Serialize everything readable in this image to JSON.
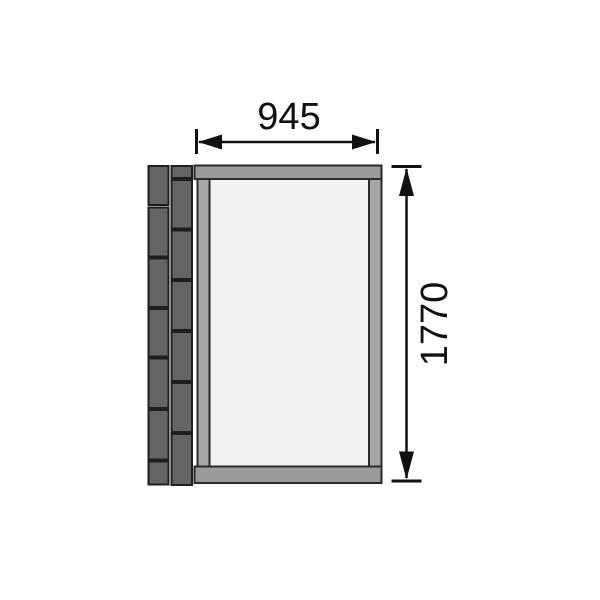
{
  "diagram": {
    "type": "technical-drawing",
    "width_dimension": {
      "label": "945"
    },
    "height_dimension": {
      "label": "1770"
    }
  },
  "colors": {
    "background": "#ffffff",
    "block_fill": "#646464",
    "block_border": "#1e1e1e",
    "rail_fill": "#9b9b9b",
    "stile_fill": "#a6a6a6",
    "panel_fill": "#f1f1f1",
    "frame_border": "#2a2a2a",
    "dimension_color": "#111111"
  },
  "wall": {
    "columns": [
      {
        "x": 148.5,
        "width": 20,
        "blocks": [
          [
            166,
            39
          ],
          [
            207.5,
            49
          ],
          [
            258.5,
            48.5
          ],
          [
            309,
            47.5
          ],
          [
            358.5,
            49.5
          ],
          [
            410,
            49.5
          ],
          [
            461.5,
            23
          ]
        ]
      },
      {
        "x": 171.5,
        "width": 20.5,
        "blocks": [
          [
            166,
            12
          ],
          [
            180,
            48.5
          ],
          [
            230.5,
            48.5
          ],
          [
            281,
            49
          ],
          [
            332,
            49
          ],
          [
            383,
            49
          ],
          [
            434,
            51
          ]
        ]
      }
    ]
  }
}
